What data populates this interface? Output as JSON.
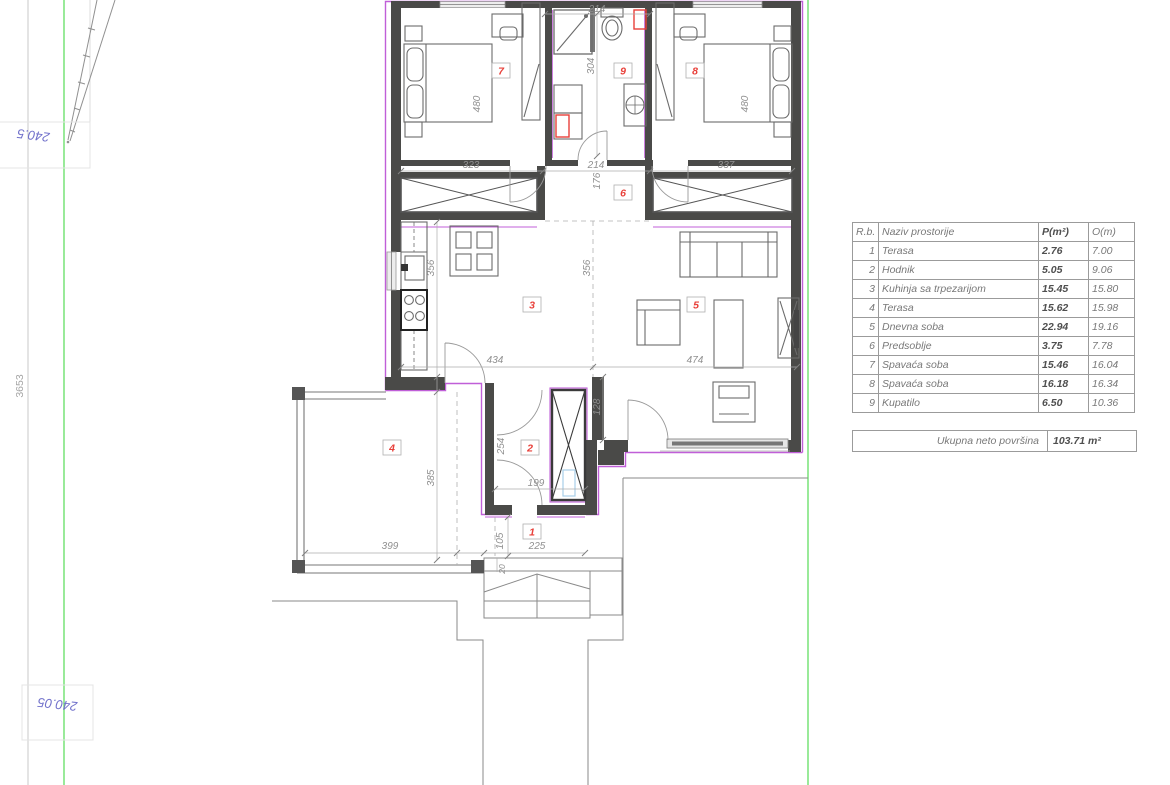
{
  "plan": {
    "room_numbers": [
      "1",
      "2",
      "3",
      "4",
      "5",
      "6",
      "7",
      "8",
      "9"
    ],
    "dims": {
      "t214": "214",
      "v304": "304",
      "v480l": "480",
      "v480r": "480",
      "b323": "323",
      "b214": "214",
      "b337": "337",
      "v176": "176",
      "v356l": "356",
      "v356r": "356",
      "b434": "434",
      "b474": "474",
      "v128": "128",
      "v254": "254",
      "b199": "199",
      "v385": "385",
      "b399": "399",
      "v105": "105",
      "b225": "225",
      "v20": "20"
    },
    "site": {
      "elevation_top": "240.5",
      "elevation_bottom": "240.05",
      "boundary_length": "3653"
    },
    "colors": {
      "wall": "#4a4a48",
      "insulation_purple": "#c05fd8",
      "site_green": "#6ee26e",
      "elevation_blue": "#7272cb",
      "room_label_red": "#e8403a"
    }
  },
  "table": {
    "headers": {
      "rb": "R.b.",
      "name": "Naziv prostorije",
      "area": "P(m²)",
      "perimeter": "O(m)"
    },
    "rows": [
      {
        "rb": "1",
        "name": "Terasa",
        "area": "2.76",
        "perimeter": "7.00"
      },
      {
        "rb": "2",
        "name": "Hodnik",
        "area": "5.05",
        "perimeter": "9.06"
      },
      {
        "rb": "3",
        "name": "Kuhinja sa trpezarijom",
        "area": "15.45",
        "perimeter": "15.80"
      },
      {
        "rb": "4",
        "name": "Terasa",
        "area": "15.62",
        "perimeter": "15.98"
      },
      {
        "rb": "5",
        "name": "Dnevna soba",
        "area": "22.94",
        "perimeter": "19.16"
      },
      {
        "rb": "6",
        "name": "Predsoblje",
        "area": "3.75",
        "perimeter": "7.78"
      },
      {
        "rb": "7",
        "name": "Spavaća soba",
        "area": "15.46",
        "perimeter": "16.04"
      },
      {
        "rb": "8",
        "name": "Spavaća soba",
        "area": "16.18",
        "perimeter": "16.34"
      },
      {
        "rb": "9",
        "name": "Kupatilo",
        "area": "6.50",
        "perimeter": "10.36"
      }
    ],
    "total_label": "Ukupna neto površina",
    "total_value": "103.71 m²"
  }
}
